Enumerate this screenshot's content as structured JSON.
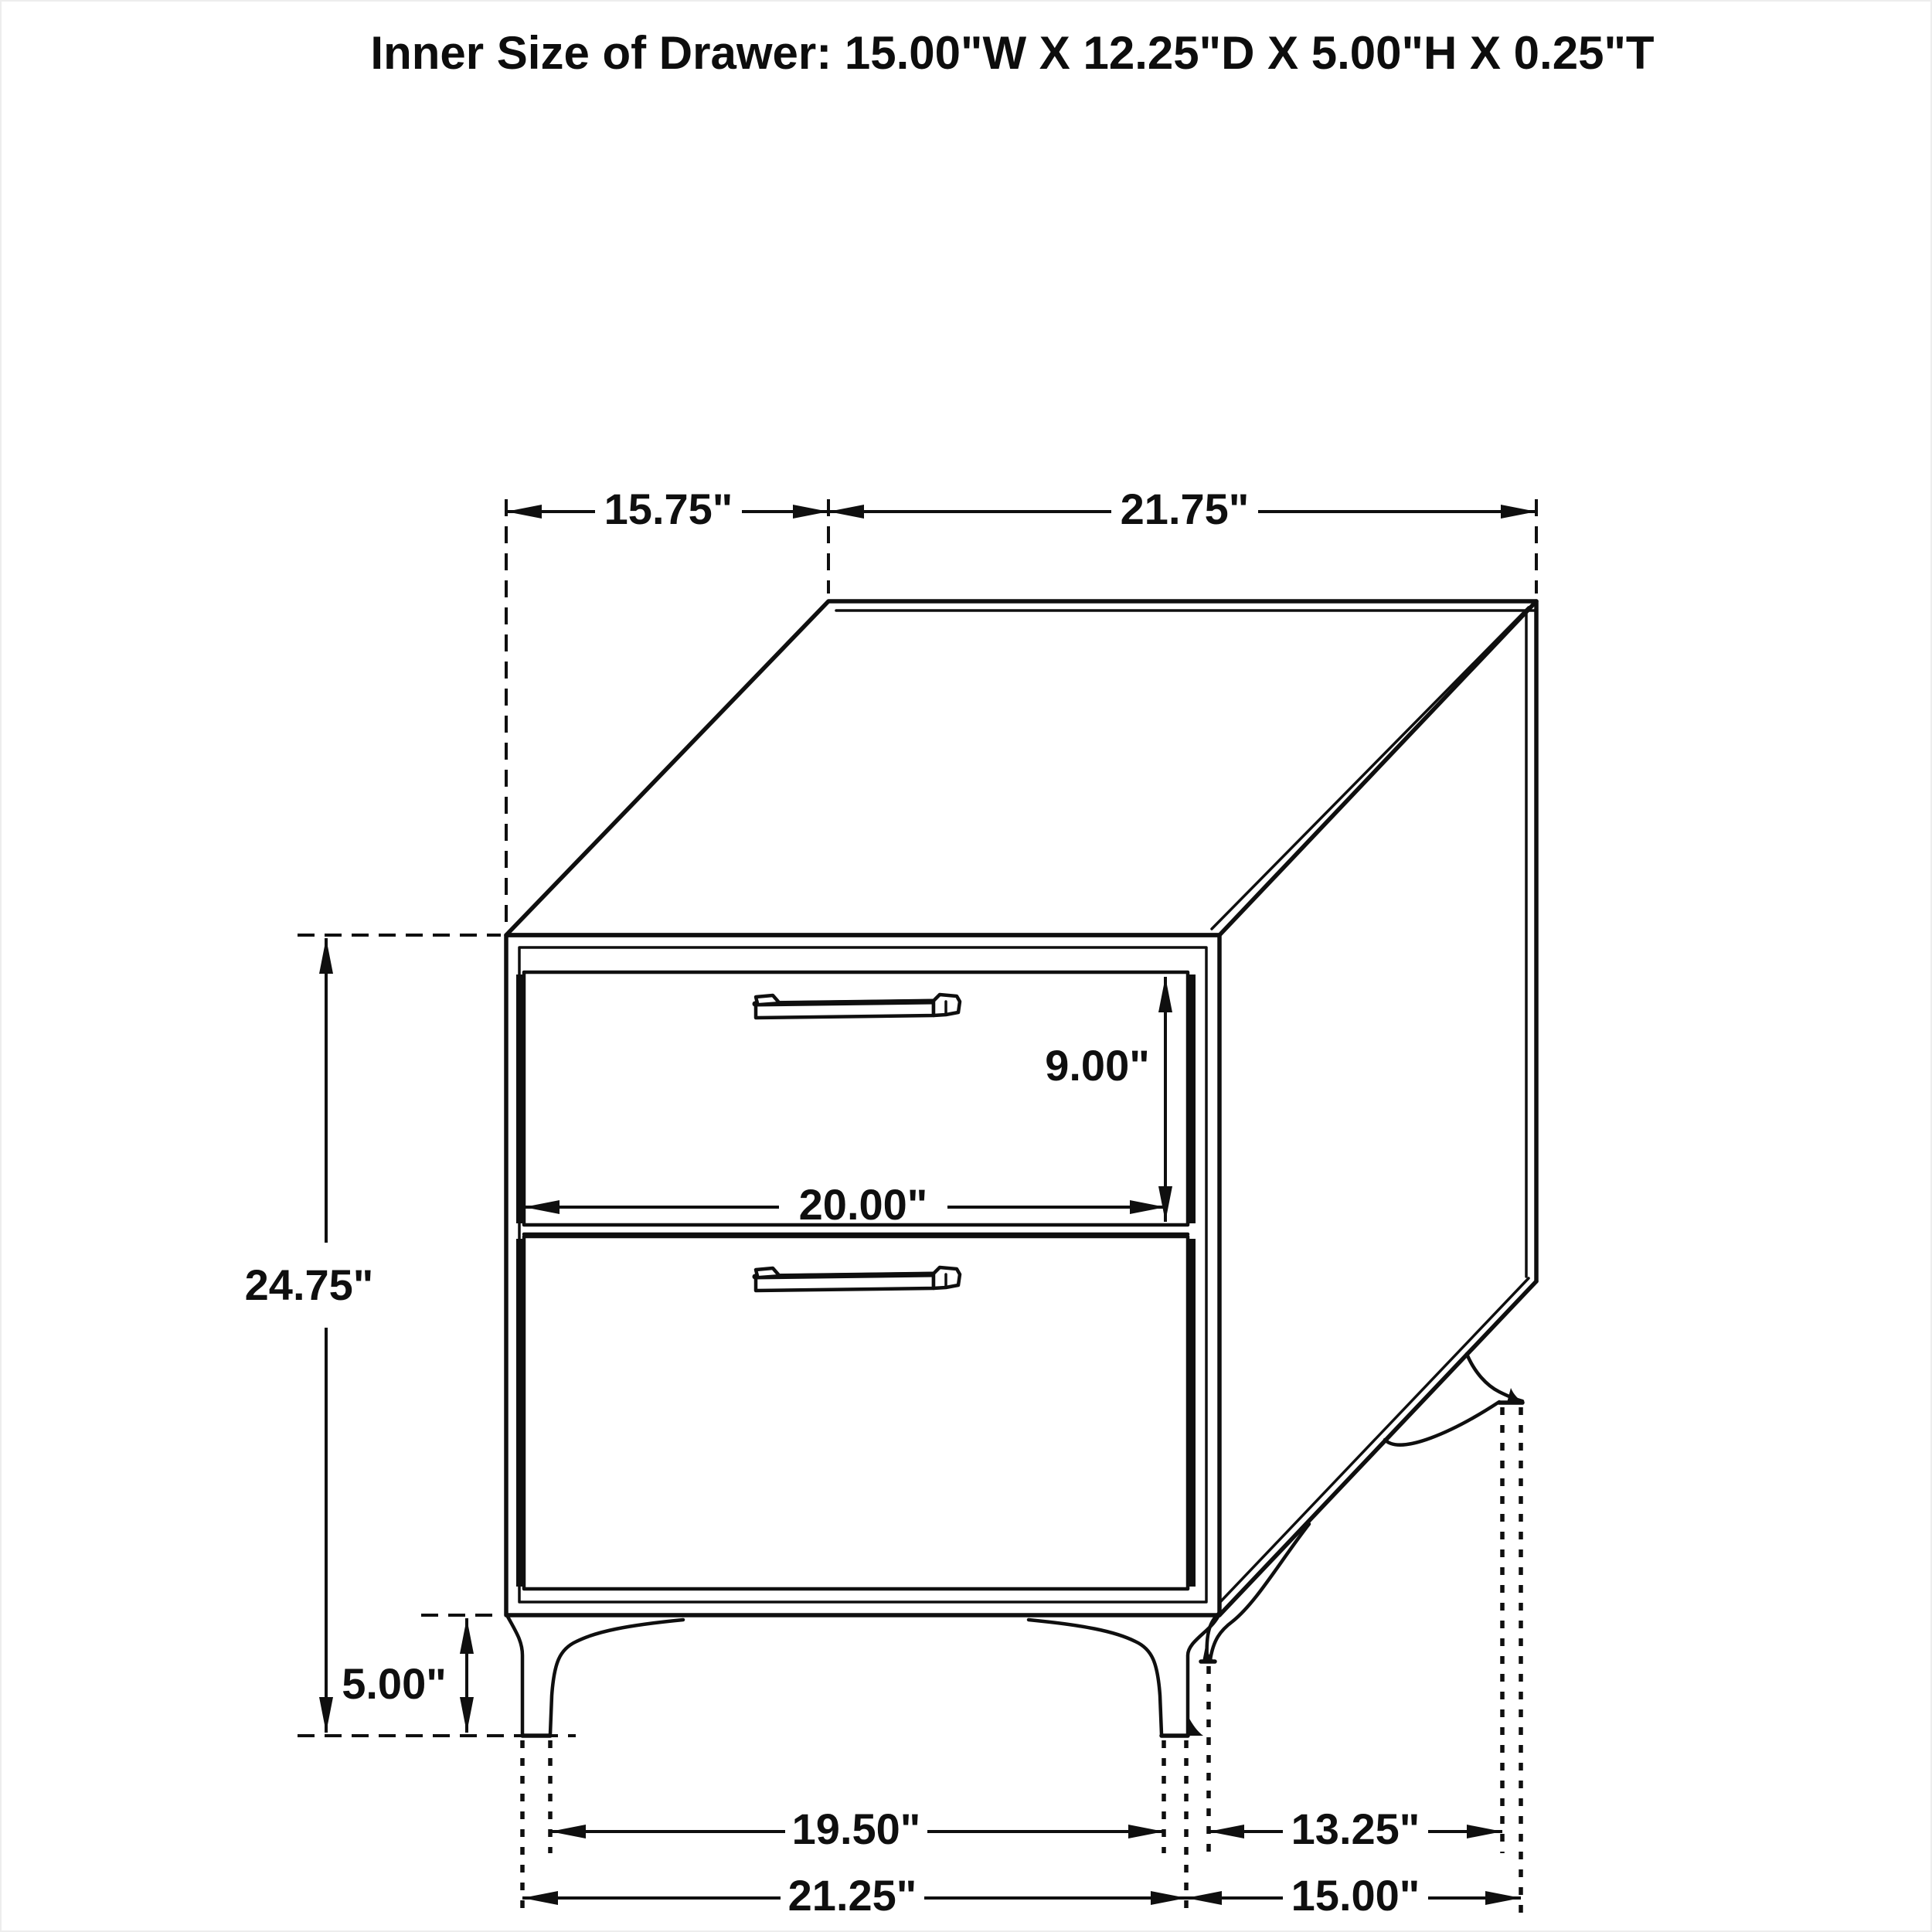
{
  "title": "Inner Size of Drawer: 15.00\"W X 12.25\"D X 5.00\"H X 0.25\"T",
  "diagram": {
    "subject": "two-drawer nightstand dimension drawing",
    "colors": {
      "line": "#0f0f0f",
      "background": "#ffffff"
    },
    "dimensions": {
      "top_depth": "15.75\"",
      "top_width": "21.75\"",
      "overall_height": "24.75\"",
      "leg_height": "5.00\"",
      "drawer_front_height": "9.00\"",
      "drawer_front_width": "20.00\"",
      "front_feet_inner_span": "19.50\"",
      "side_feet_inner_span": "13.25\"",
      "front_feet_outer_span": "21.25\"",
      "side_feet_outer_span": "15.00\""
    },
    "inner_drawer_size": {
      "width": "15.00\"W",
      "depth": "12.25\"D",
      "height": "5.00\"H",
      "thickness": "0.25\"T"
    }
  }
}
